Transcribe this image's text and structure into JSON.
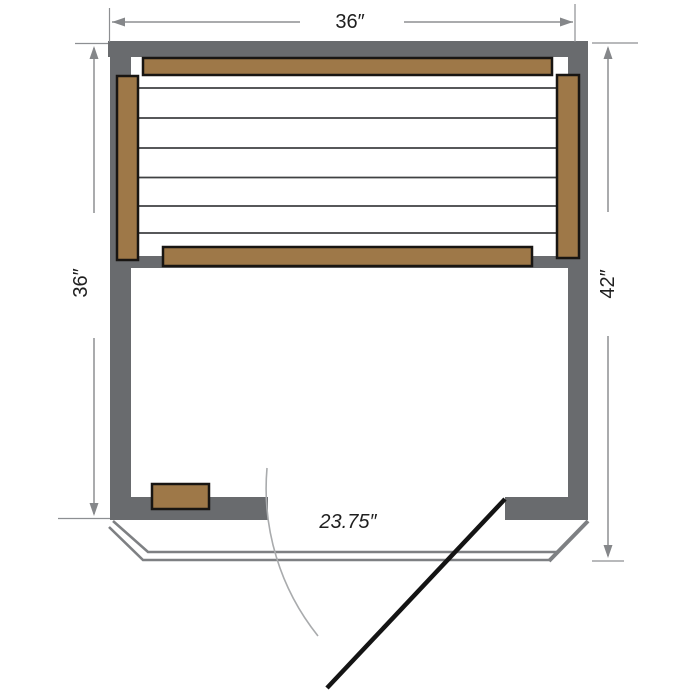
{
  "diagram": {
    "description": "sauna-floor-plan",
    "dimensions": {
      "top_width": "36″",
      "left_depth": "36″",
      "right_depth": "42″",
      "door_width": "23.75″"
    },
    "colors": {
      "background": "#ffffff",
      "wall": "#696b6e",
      "wood": "#9e7848",
      "wood_outline": "#181512",
      "slat": "#3f4143",
      "dimension_line": "#8d8f92",
      "arrow": "#85878a",
      "label_text": "#1f1f1f",
      "base_outline": "#7e8083",
      "arc": "#a9abad",
      "door": "#141414"
    }
  }
}
